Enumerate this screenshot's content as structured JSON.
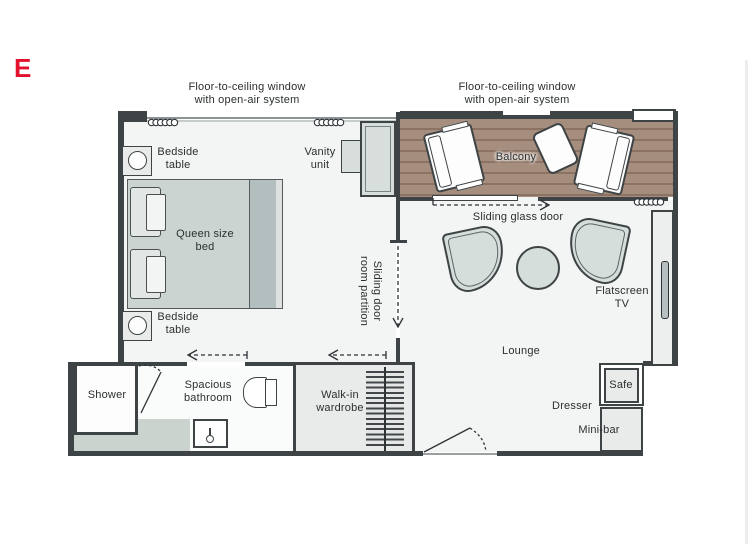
{
  "brand": {
    "logo_letter": "E",
    "logo_color": "#e4112d"
  },
  "annotations": {
    "window_label_left": {
      "line1": "Floor-to-ceiling window",
      "line2": "with open-air system"
    },
    "window_label_right": {
      "line1": "Floor-to-ceiling window",
      "line2": "with open-air system"
    },
    "bedside_table_top": {
      "line1": "Bedside",
      "line2": "table"
    },
    "bedside_table_bottom": {
      "line1": "Bedside",
      "line2": "table"
    },
    "queen_bed": {
      "line1": "Queen size",
      "line2": "bed"
    },
    "vanity_unit": {
      "line1": "Vanity",
      "line2": "unit"
    },
    "room_partition": {
      "line1": "Sliding door",
      "line2": "room partition"
    },
    "balcony": "Balcony",
    "sliding_glass_door": "Sliding glass door",
    "flatscreen_tv": {
      "line1": "Flatscreen",
      "line2": "TV"
    },
    "lounge": "Lounge",
    "shower": "Shower",
    "bathroom": {
      "line1": "Spacious",
      "line2": "bathroom"
    },
    "wardrobe": {
      "line1": "Walk-in",
      "line2": "wardrobe"
    },
    "safe": "Safe",
    "dresser": "Dresser",
    "minibar": "Mini-bar"
  },
  "colors": {
    "accent_red": "#e4112d",
    "wall": "#3e4346",
    "floor": "#f3f4f4",
    "wood_light": "#a68e7e",
    "wood_dark": "#8b7263",
    "furniture_fill": "#e9ebea",
    "upholstery_fill": "#d6dedb",
    "bed_fill": "#ccd4d1",
    "text": "#2b2f30"
  }
}
